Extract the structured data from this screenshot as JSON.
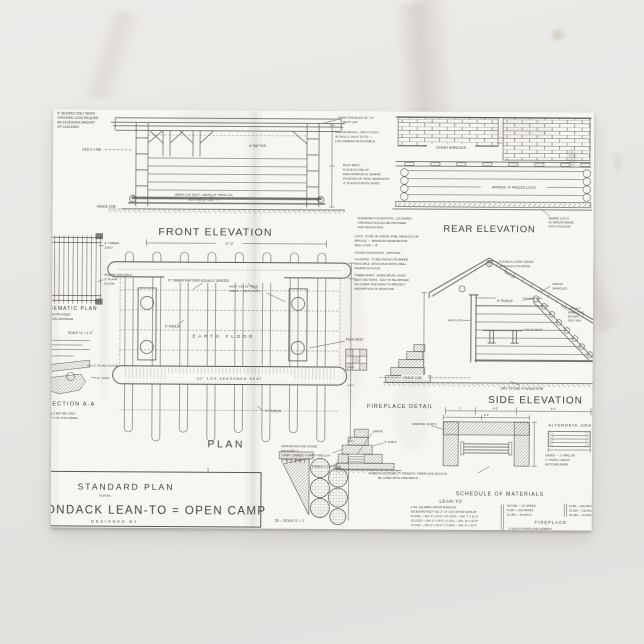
{
  "scene": {
    "background": "#e9e6e3",
    "paper": "#f8f6f2",
    "ink": "#4a4641"
  },
  "drawing": {
    "front_elevation": {
      "title": "FRONT ELEVATION",
      "corner_note": [
        "IF DESIRED ONLY WHEN",
        "CROOKED LOGS REQUIRE",
        "AN EXCESSIVE AMOUNT",
        "OF CAULKING."
      ],
      "ceiling_line": "CEIL'G LINE",
      "rafter": "6' RAFTER",
      "seat_note_1": "HEWN LOG SEAT—HEWN 10\" WIDE LOG",
      "seat_note_2": "BOTTOM 16\" LOG",
      "grade_line": "GRADE LINE",
      "width_dim": "17'-0\""
    },
    "rear_elevation": {
      "title": "REAR ELEVATION",
      "cedar_shingles": "CEDAR SHINGLES",
      "peeled_logs": "APPROX. 9\" PEELED LOGS",
      "edge_note": [
        "WHERE LOG IS",
        "EXTERIOR GRADE",
        "WITH CAULKING"
      ]
    },
    "mid_notes": {
      "shingle_note": [
        "SAWN SHINGLES 36\" x 4\"",
        "BUTT LAP"
      ],
      "dovetail_note": [
        "USE DOVETAIL—SPLIT LOGS",
        "IN WALLS, HALF CUTS —",
        "LOG DIMENS ADJUSTABLE."
      ],
      "pack_rest_note": [
        "PACK REST :",
        "PLACE IN LINE OF",
        "MAIN APPROACH, WHERE",
        "POSITION OF TRAIL WARRANTS",
        "IT, PLACE IN BOTH SIDES."
      ]
    },
    "construction_notes": {
      "ventilation": [
        "SCREENED FOUNDATION : LOUVERED",
        "OPENINGS SHOULD BE PROVIDED",
        "FOR VENTILATION."
      ],
      "logs": [
        "LOGS : TO BE OF CEDAR, PINE, HEMLOCK OR",
        "SPRUCE, — MINIMUM DIAMETER FOR",
        "WALL LOGS — 8\"."
      ],
      "foundation": "STONE FOUNDATION : OPTIONAL",
      "caulking": [
        "CAULKING : TO BE OAKUM OR WHERE",
        "AVAILABLE, SPHAGNUM MOSS, WELL",
        "TAMPED IN PLACE."
      ],
      "timber_ends": [
        "TIMBER ENDS : ADZED BEVEL GIVES",
        "BEST SECTIONS ; SALT TO BE APPLIED",
        "ON UNDER SIDE ENDS TO PREVENT",
        "ABSORPTION OF MOISTURE."
      ]
    },
    "plan": {
      "title": "PLAN",
      "rafters_note": "6\" TIMBER RAFTERS EQUALLY SPACED",
      "half_log_note": [
        "HALF LOG 10\" WIDE",
        "SHELF — WITH PEGS"
      ],
      "purlin": "6\" PURLIN",
      "earth_floor": "EARTH FLOOR",
      "seat": "10\" LOG   SEASONED   SEAT",
      "purlin_2": "6\" PURLIN",
      "pack_rest": "PACK REST"
    },
    "left_column": {
      "timber_joist": [
        "6\" TIMBER",
        "JOIST"
      ],
      "plank_floor": [
        "WHERE AVAILABLE",
        "2\" PLANK",
        "FLOOR"
      ],
      "schematic_plan": "SCHEMATIC PLAN",
      "drainage_note": [
        "MAY BE PROVIDED",
        "FOR SITE DRAINAGE"
      ],
      "scale": "SCALE  ¼\" = 1'-0\"",
      "plank_1": "1\" PLANK FLOOR",
      "joist_6": "6\" JOIST",
      "section": "SECTION A-A",
      "dowel_note": [
        "DOWELS MAY BE USED",
        "QUALITY OF SITE VARIES"
      ]
    },
    "side_elevation": {
      "title": "SIDE ELEVATION",
      "ridge_note": [
        "DOUBLE LAYER CEDAR",
        "SHINGLES ON RIDGE"
      ],
      "cedar_shingles": [
        "CEDAR",
        "SHINGLES"
      ],
      "purlin": "6\" PURLIN",
      "half_log": "HALF LOG",
      "pack_rest": "PACK REST",
      "rafter": "RAFTER",
      "asphalt_note": [
        "ASPHALT",
        "PERMITTED",
        "EXCEPT",
        "ONLY WH"
      ],
      "grade_line": "GRADE LINE",
      "foundation": "DRY STONE FOUNDATION",
      "dims": [
        "2'",
        "4'-0\"",
        "6'-0\""
      ]
    },
    "fireplace_detail": {
      "title": "FIREPLACE DETAIL",
      "grate": "GRATE",
      "shelf": "4\" SHELF",
      "mortar_joints": "MORTAR JOINTS",
      "mortar_mix": [
        "MORTAR MIX FOR STONE",
        "MASONRY C :",
        "1 PART CEMENT, ¼ PART FIRECLAY",
        "3 PARTS SAND"
      ],
      "rubble": "RUBBLE CONCRETE",
      "firebrick_note": [
        "WHEN ACCESSIBILITY PERMITS, FIREPLACE SHOULD",
        "BE LINED WITH FIRE BRICK."
      ],
      "alternate": "ALTERNATE GRATE",
      "alt_grate_note": [
        "GRATE — 1\" PIPE OR",
        "¾\" RODS, LAID IN",
        "NOTCHED BARS"
      ],
      "width_dim": "4'-0\"",
      "scale_note": "28 — SCALE ¾\" = 1'"
    },
    "schedule": {
      "title": "SCHEDULE OF MATERIALS",
      "lean_to": "LEAN-TO",
      "lean_to_rows": [
        "2 SQ. SQUARES   CEDAR SHINGLES",
        "600 BOARD FEET   T&G 2\" x 8\" S1S, OR FIR SHIPLAP",
        "8 LOGS — DIA. 8\" x 16'-0\"  |  10 LOGS — DIA. 7\" x 12'-0\"",
        "10 LOGS — DIA. 9\" x 18'-0\"  |  1 LOG — DIA. 14\" x 10'-0\"",
        "3 LOGS — DIA. 6\" x 16'-0\"  |  7 LOGS — DIA. 8\" x 10'-0\""
      ],
      "hardware_col_1": [
        "100 LBS — 10\" SPIKES",
        "8 LBS — 40d SPIKES",
        "10 LBS — 8d NAILS"
      ],
      "hardware_col_2": [
        "8 LBS — 60d SPIKES",
        "10 LBS — 10d NAILS",
        "10 LBS — 3d ZINC CL."
      ],
      "fireplace": "FIREPLACE",
      "fireplace_row": "2 SACKS PORTLAND CEMENT"
    },
    "title_block": {
      "line_1": "STANDARD PLAN",
      "line_2": "FOR AN",
      "line_3": "ADIRONDACK LEAN-TO = OPEN CAMP",
      "line_4": "DESIGNED BY"
    }
  }
}
